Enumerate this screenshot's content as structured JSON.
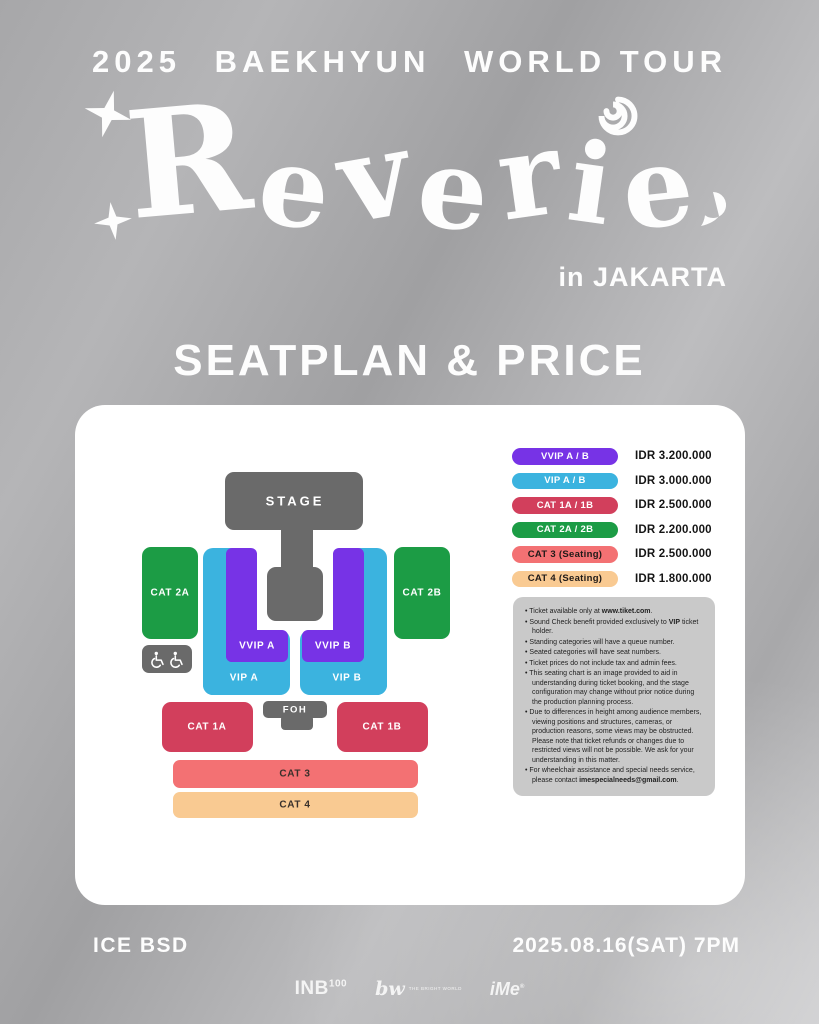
{
  "header": {
    "year": "2025",
    "artist": "BAEKHYUN",
    "tour": "WORLD TOUR"
  },
  "logo": {
    "title": "Reverie",
    "city": "in JAKARTA",
    "icons": [
      "star-icon",
      "star-icon",
      "spiral-icon",
      "comma-blob-icon"
    ]
  },
  "section_title": "SEATPLAN & PRICE",
  "seatmap": {
    "stage": "STAGE",
    "foh": "FOH",
    "cat2a": "CAT 2A",
    "cat2b": "CAT 2B",
    "vvip_a": "VVIP A",
    "vvip_b": "VVIP B",
    "vip_a": "VIP A",
    "vip_b": "VIP B",
    "cat1a": "CAT 1A",
    "cat1b": "CAT 1B",
    "cat3": "CAT 3",
    "cat4": "CAT 4",
    "wheelchair_icon": "wheelchair-icon"
  },
  "legend": {
    "rows": [
      {
        "label": "VVIP A / B",
        "price": "IDR 3.200.000",
        "color": "#7733E6",
        "text": "#FFFFFF"
      },
      {
        "label": "VIP A / B",
        "price": "IDR 3.000.000",
        "color": "#3BB3DF",
        "text": "#FFFFFF"
      },
      {
        "label": "CAT 1A / 1B",
        "price": "IDR 2.500.000",
        "color": "#D23F5C",
        "text": "#FFFFFF"
      },
      {
        "label": "CAT 2A / 2B",
        "price": "IDR 2.200.000",
        "color": "#1C9C45",
        "text": "#FFFFFF"
      },
      {
        "label": "CAT 3 (Seating)",
        "price": "IDR 2.500.000",
        "color": "#F37173",
        "text": "#1F1A18"
      },
      {
        "label": "CAT 4 (Seating)",
        "price": "IDR 1.800.000",
        "color": "#F9CA92",
        "text": "#1F1A18"
      }
    ]
  },
  "notes": {
    "items": [
      {
        "pre": "Ticket available only at ",
        "bold": "www.tiket.com",
        "post": "."
      },
      {
        "pre": "Sound Check benefit provided exclusively to ",
        "bold": "VIP",
        "post": " ticket holder."
      },
      {
        "pre": "Standing categories will have a queue number.",
        "bold": "",
        "post": ""
      },
      {
        "pre": "Seated categories will have seat numbers.",
        "bold": "",
        "post": ""
      },
      {
        "pre": "Ticket prices do not include tax and admin fees.",
        "bold": "",
        "post": ""
      },
      {
        "pre": "This seating chart is an image provided to aid in understanding during ticket booking, and the stage configuration may change without prior notice during the production planning process.",
        "bold": "",
        "post": ""
      },
      {
        "pre": "Due to differences in height among audience members, viewing positions and structures, cameras, or production reasons, some views may be obstructed. Please note that ticket refunds or changes due to restricted views will not be possible. We ask for your understanding in this matter.",
        "bold": "",
        "post": ""
      },
      {
        "pre": "For wheelchair assistance and special needs service, please contact ",
        "bold": "imespecialneeds@gmail.com",
        "post": "."
      }
    ]
  },
  "footer": {
    "venue": "ICE BSD",
    "datetime": "2025.08.16(SAT) 7PM",
    "logos": {
      "inb": {
        "text": "INB",
        "sup": "100"
      },
      "bw": {
        "mark": "bw",
        "caption": "THE BRIGHT WORLD"
      },
      "ime": {
        "text": "iMe",
        "reg": "®"
      }
    }
  },
  "colors": {
    "vvip": "#7733E6",
    "vip": "#3BB3DF",
    "cat1": "#D23F5C",
    "cat2": "#1C9C45",
    "cat3": "#F37173",
    "cat4": "#F9CA92",
    "stage": "#6A6A6A",
    "notes_bg": "#C9C9C9",
    "card": "#FFFFFF"
  }
}
